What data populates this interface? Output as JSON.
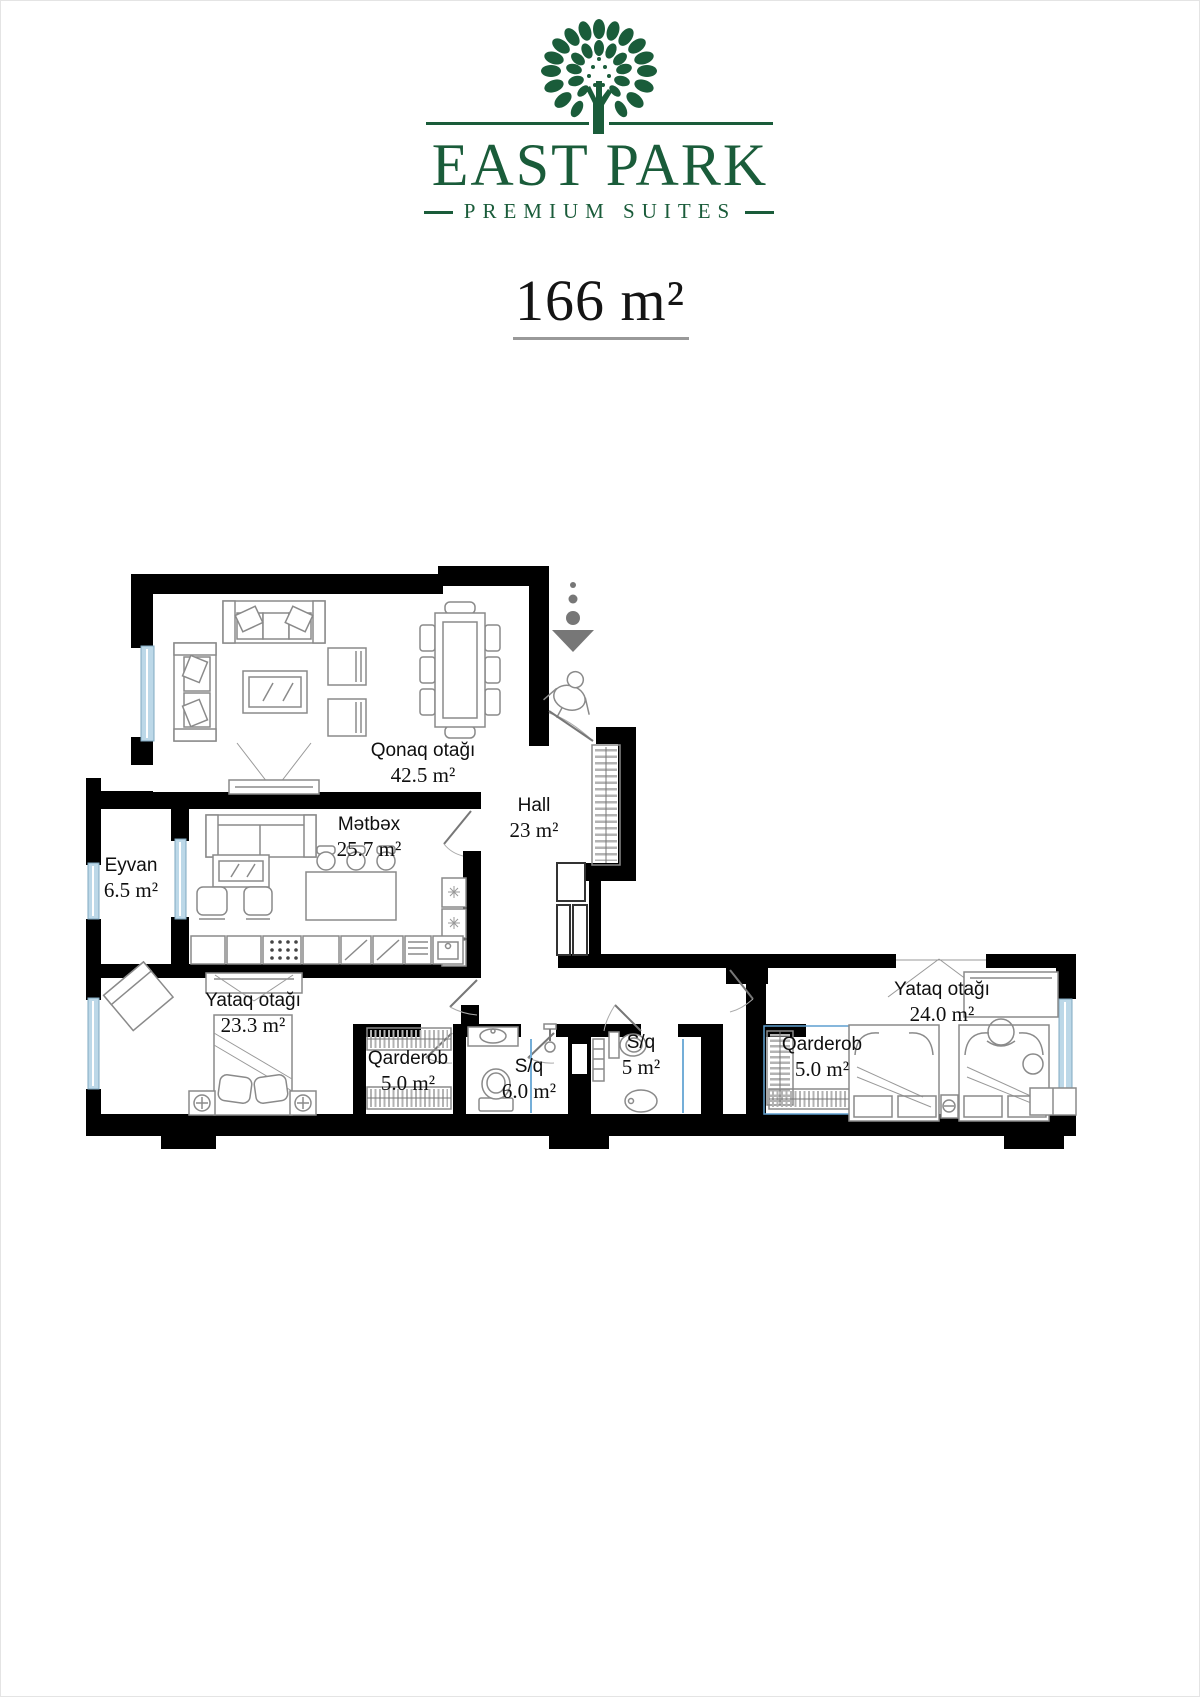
{
  "logo": {
    "brand": "EAST PARK",
    "subtitle": "PREMIUM SUITES",
    "tree_icon": "tree-icon",
    "brand_color": "#1a5c3a"
  },
  "title": {
    "total_area": "166 m²"
  },
  "plan": {
    "entrance": {
      "arrow_icon": "entrance-arrow-down-icon",
      "person_icon": "person-top-view-icon"
    },
    "rooms": [
      {
        "id": "qonaq-otagi",
        "name": "Qonaq otağı",
        "area": "42.5 m²"
      },
      {
        "id": "hall",
        "name": "Hall",
        "area": "23 m²"
      },
      {
        "id": "metbex",
        "name": "Mətbəx",
        "area": "25.7 m²"
      },
      {
        "id": "eyvan",
        "name": "Eyvan",
        "area": "6.5 m²"
      },
      {
        "id": "yataq-left",
        "name": "Yataq otağı",
        "area": "23.3 m²"
      },
      {
        "id": "qarderob-left",
        "name": "Qarderob",
        "area": "5.0 m²"
      },
      {
        "id": "sq-left",
        "name": "S/q",
        "area": "6.0 m²"
      },
      {
        "id": "sq-right",
        "name": "S/q",
        "area": "5 m²"
      },
      {
        "id": "qarderob-right",
        "name": "Qarderob",
        "area": "5.0 m²"
      },
      {
        "id": "yataq-right",
        "name": "Yataq otağı",
        "area": "24.0 m²"
      }
    ],
    "colors": {
      "wall": "#000000",
      "window": "#bcd8e8",
      "glass_partition": "#74aed8",
      "wardrobe_outline": "#5f9fd0",
      "furniture_outline": "#8a8a8a"
    }
  }
}
